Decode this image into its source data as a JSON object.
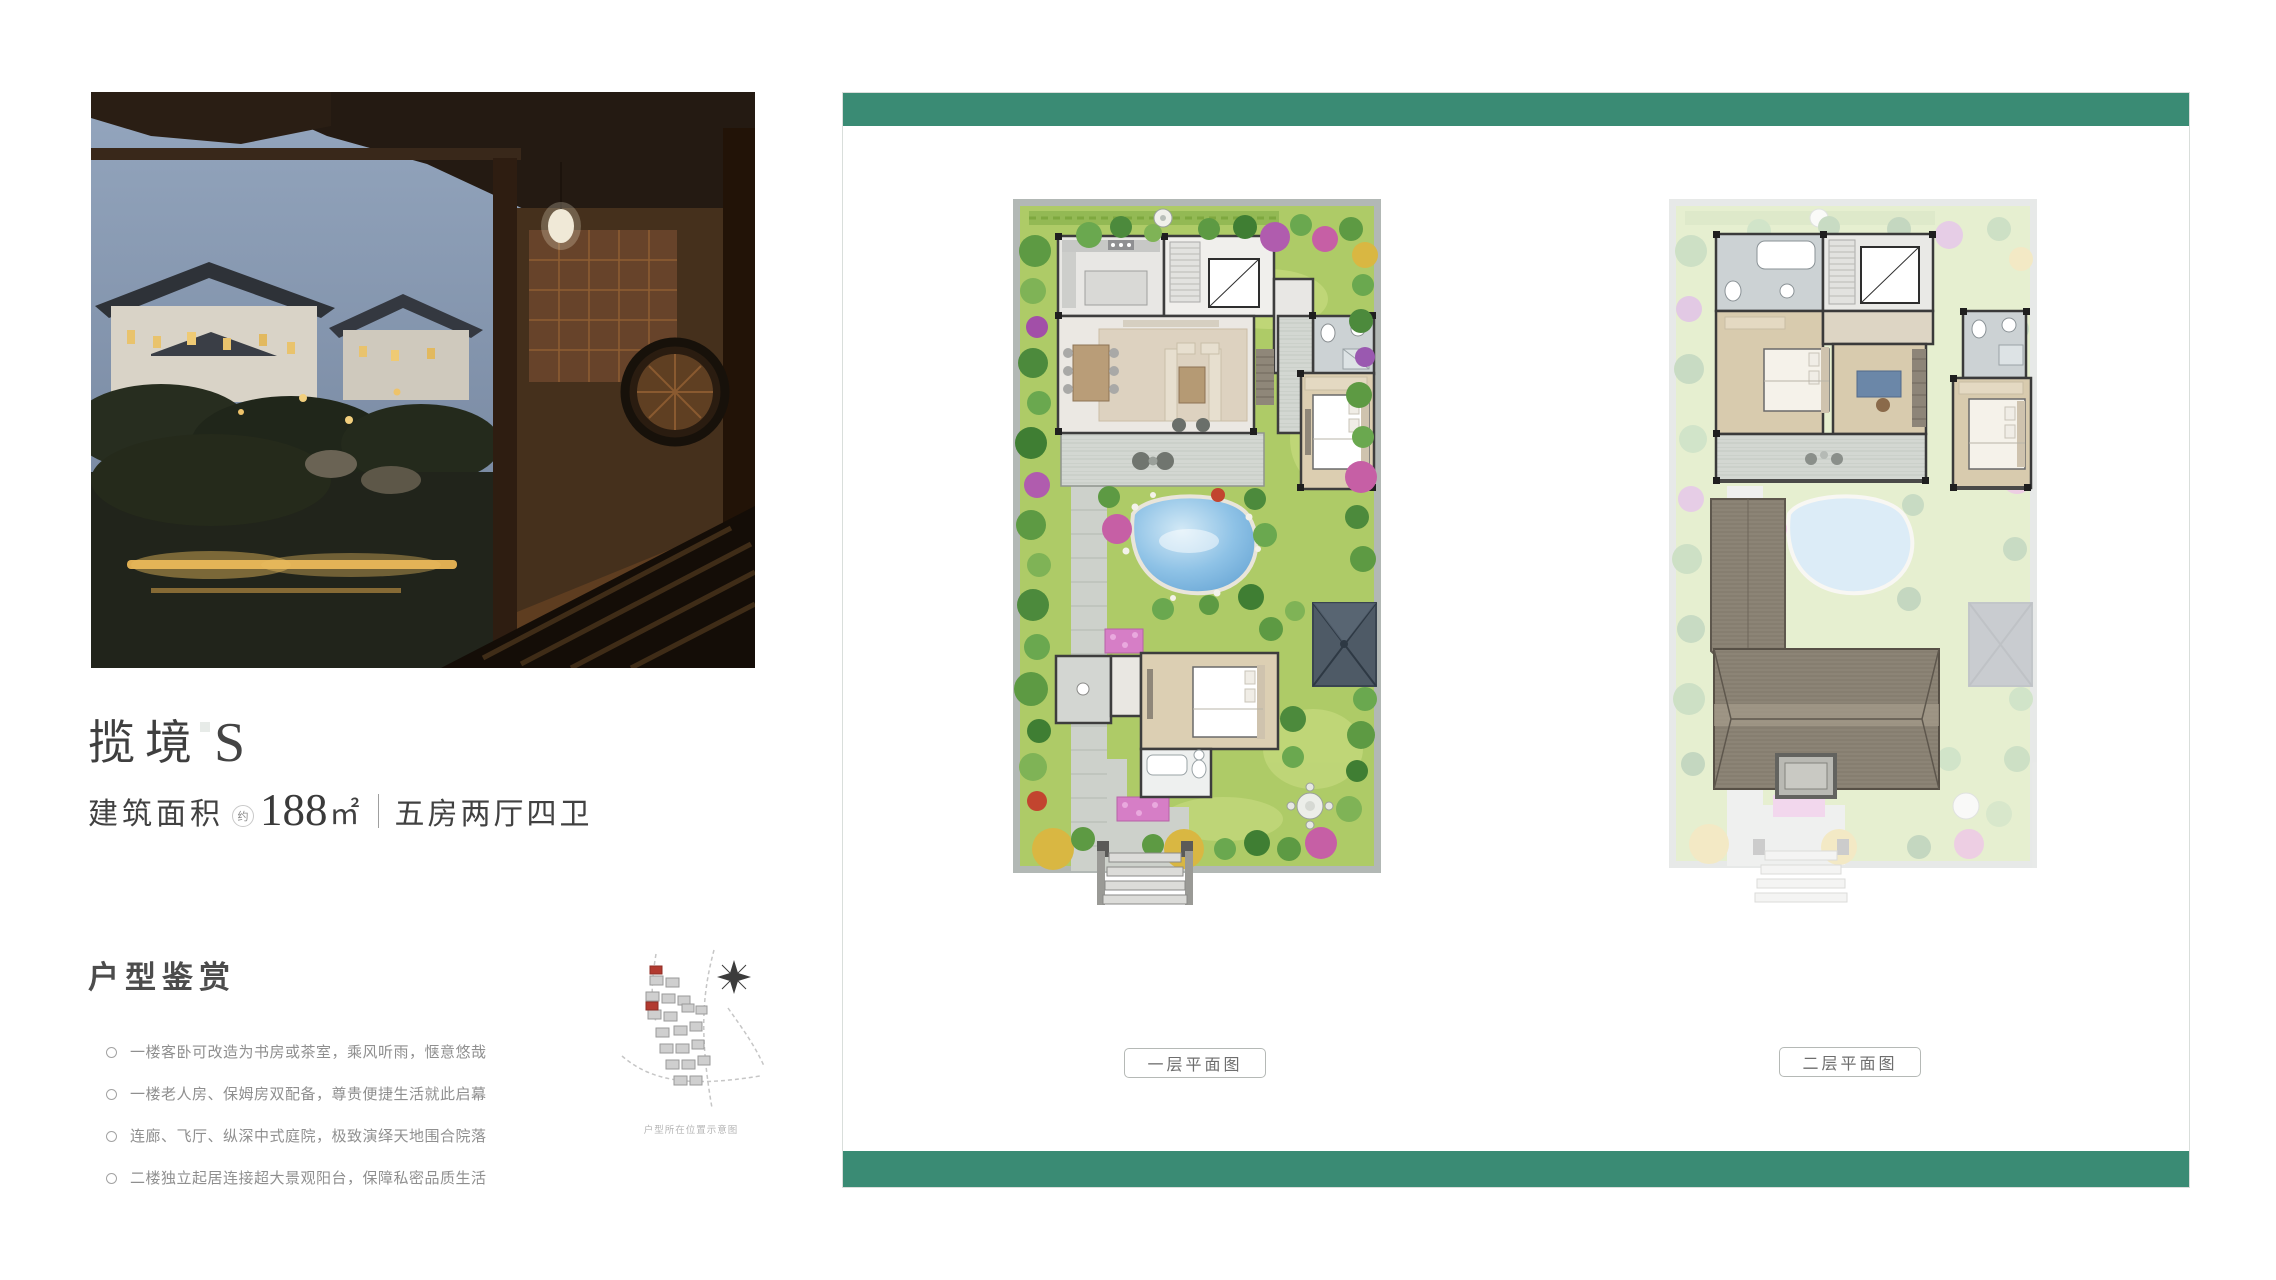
{
  "colors": {
    "accent_teal": "#3a8b74"
  },
  "left_column": {
    "title": {
      "main": "揽境",
      "suffix": "S"
    },
    "spec": {
      "label": "建筑面积",
      "approx": "约",
      "area": "188",
      "unit": "㎡",
      "layout": "五房两厅四卫"
    },
    "section_heading": "户型鉴赏",
    "bullets": [
      "一楼客卧可改造为书房或茶室，乘风听雨，惬意悠哉",
      "一楼老人房、保姆房双配备，尊贵便捷生活就此启幕",
      "连廊、飞厅、纵深中式庭院，极致演绎天地围合院落",
      "二楼独立起居连接超大景观阳台，保障私密品质生活"
    ],
    "sitemap_caption": "户型所在位置示意图"
  },
  "right_panel": {
    "plan1_label": "一层平面图",
    "plan2_label": "二层平面图"
  }
}
